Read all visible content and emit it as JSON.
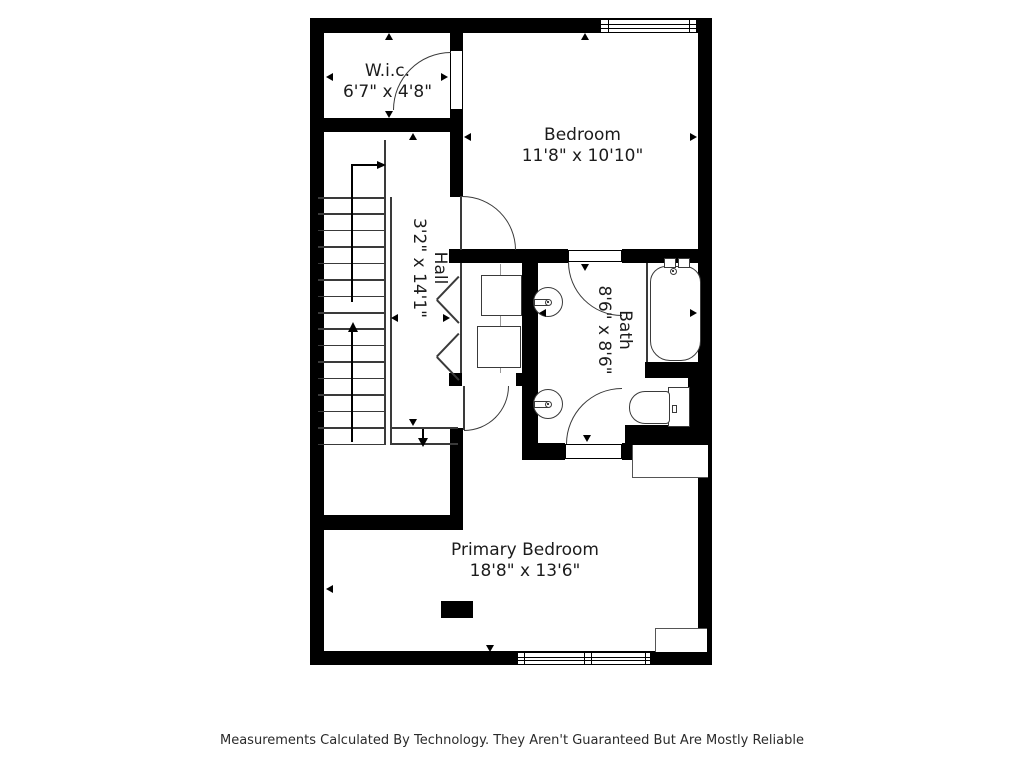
{
  "footer": {
    "text": "Measurements Calculated By Technology. They Aren't Guaranteed But Are Mostly Reliable"
  },
  "rooms": [
    {
      "name": "W.i.c.",
      "dimensions": "6'7\" x 4'8\""
    },
    {
      "name": "Bedroom",
      "dimensions": "11'8\" x 10'10\""
    },
    {
      "name": "Hall",
      "dimensions": "3'2\" x 14'1\""
    },
    {
      "name": "Bath",
      "dimensions": "8'6\" x 8'6\""
    },
    {
      "name": "Primary Bedroom",
      "dimensions": "18'8\" x 13'6\""
    }
  ],
  "fixtures": [
    "staircase-with-direction-arrows",
    "bifold-closet-doors",
    "stacked-closet-shelves",
    "double-vanity-sinks",
    "bathtub",
    "toilet",
    "hinged-doors",
    "windows",
    "dimension-ticks"
  ],
  "colors": {
    "walls": "#000000",
    "fixture_lines": "#3a3a3a",
    "text": "#1c1c1c",
    "background": "#ffffff"
  }
}
